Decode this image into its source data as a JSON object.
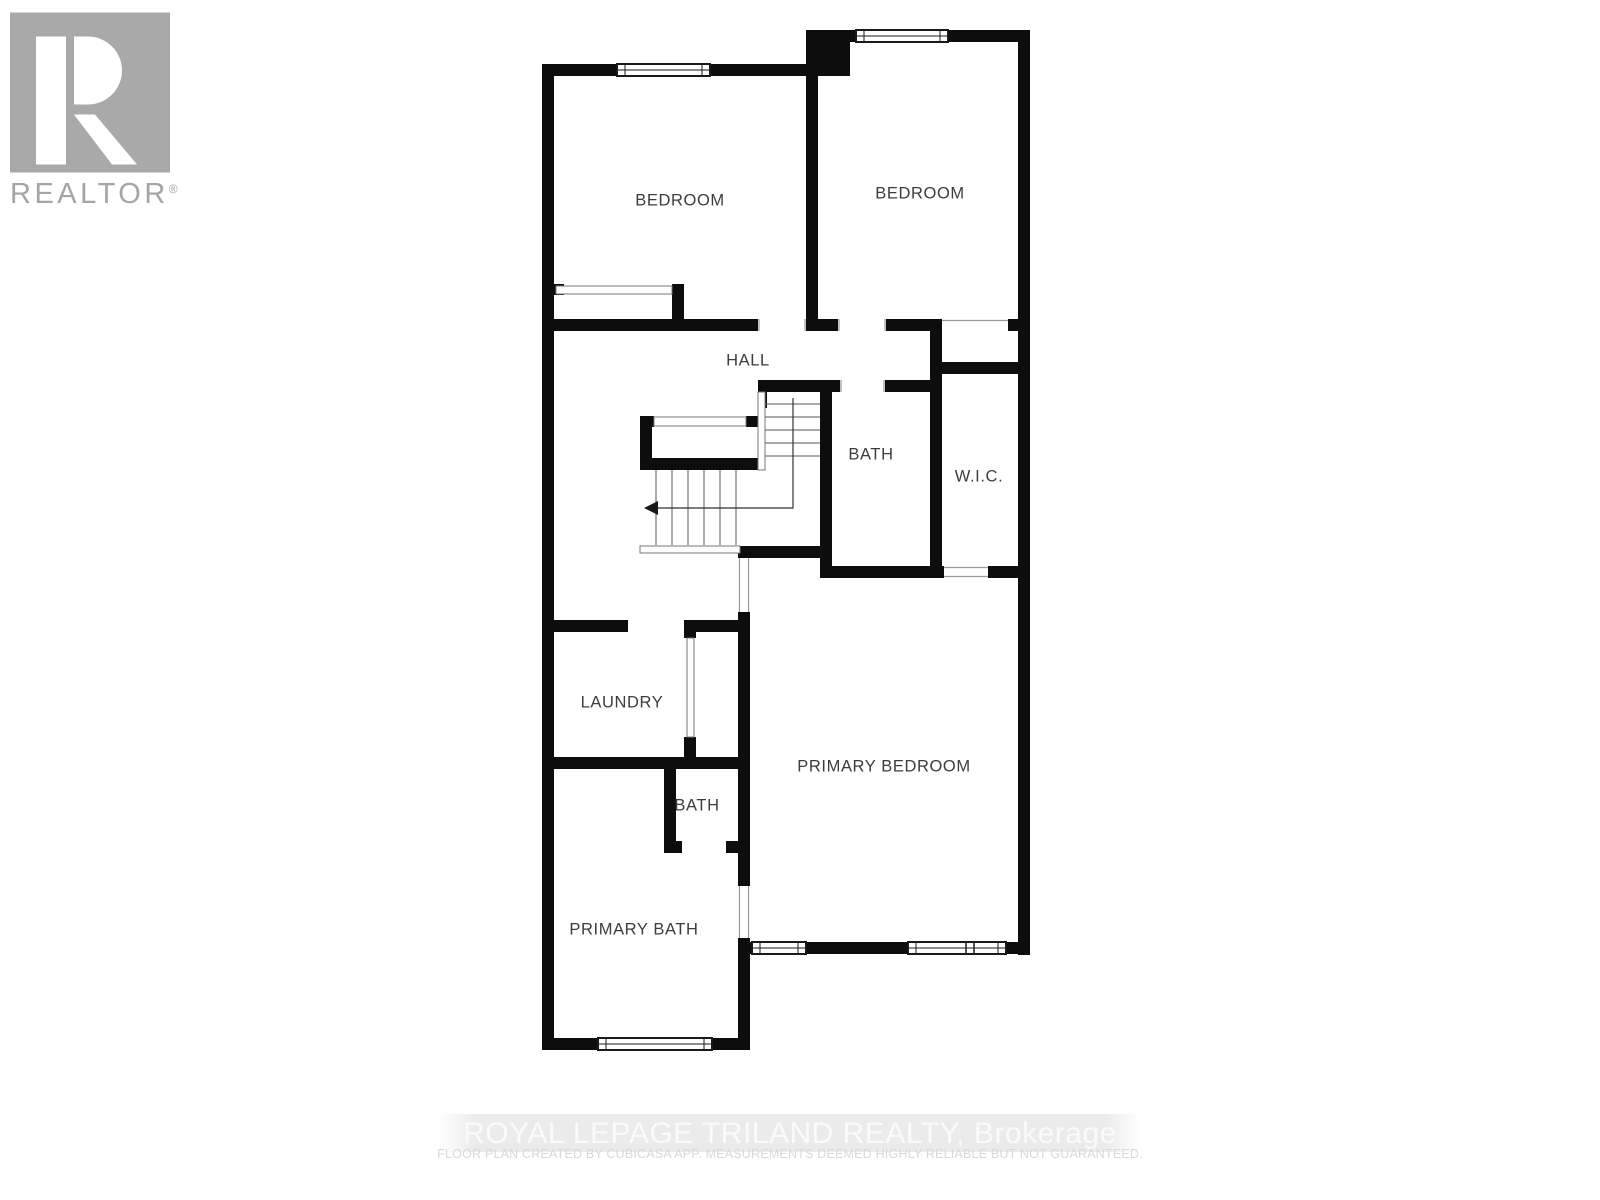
{
  "logo": {
    "realtor_label": "REALTOR",
    "registered_mark": "®",
    "box_color": "#a9a9a9",
    "text_color": "#a5a5a5"
  },
  "floor_plan": {
    "wall_color": "#0d0d0d",
    "thin_line_color": "#8c8c8c",
    "rooms": [
      {
        "id": "bedroom-left",
        "label": "BEDROOM"
      },
      {
        "id": "bedroom-right",
        "label": "BEDROOM"
      },
      {
        "id": "hall",
        "label": "HALL"
      },
      {
        "id": "bath-upper",
        "label": "BATH"
      },
      {
        "id": "wic",
        "label": "W.I.C."
      },
      {
        "id": "laundry",
        "label": "LAUNDRY"
      },
      {
        "id": "primary-bedroom",
        "label": "PRIMARY BEDROOM"
      },
      {
        "id": "bath-small",
        "label": "BATH"
      },
      {
        "id": "primary-bath",
        "label": "PRIMARY BATH"
      }
    ]
  },
  "footer": {
    "brokerage_line": "ROYAL LEPAGE TRILAND REALTY, Brokerage",
    "disclaimer_line": "FLOOR PLAN CREATED BY CUBICASA APP. MEASUREMENTS DEEMED HIGHLY RELIABLE BUT NOT GUARANTEED."
  }
}
